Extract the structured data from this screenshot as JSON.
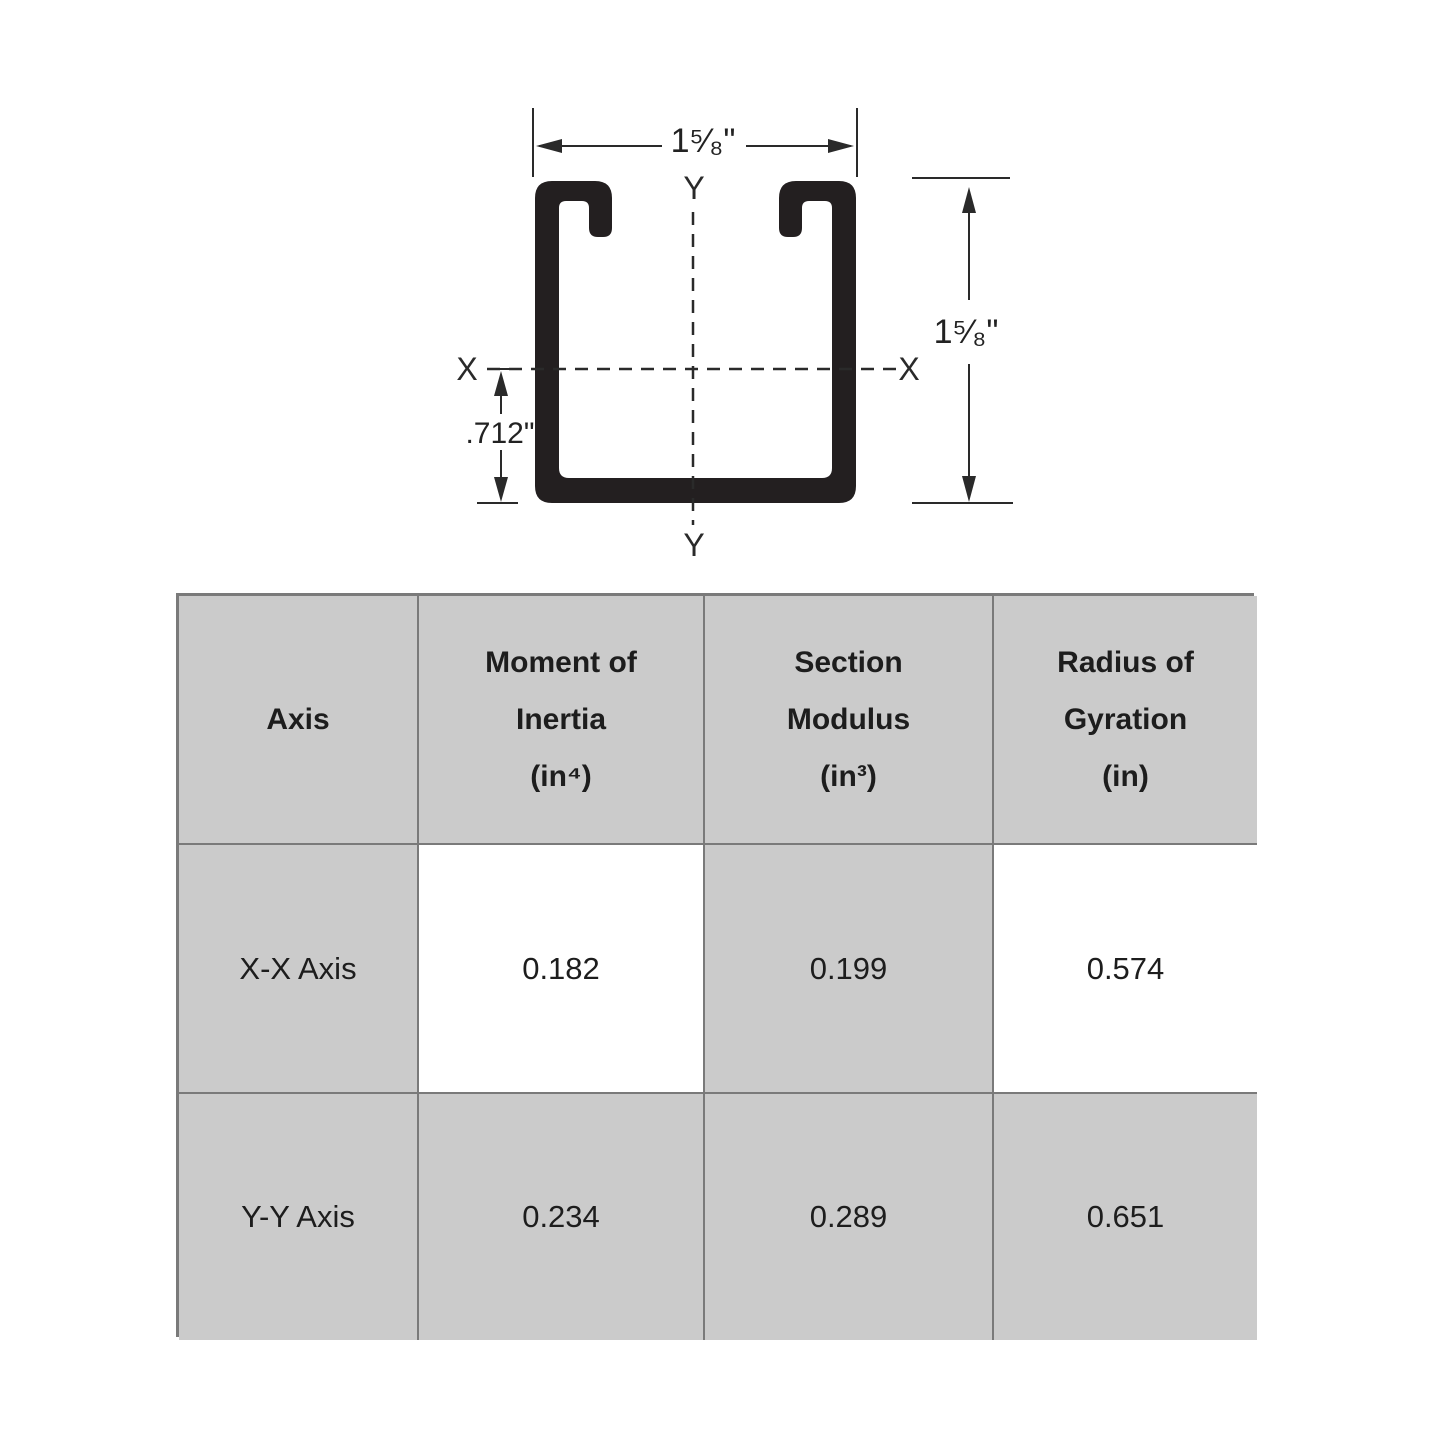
{
  "diagram": {
    "ink_color": "#231f20",
    "line_color": "#2a2a2a",
    "width_dim": "1⁵⁄₈\"",
    "height_dim": "1⁵⁄₈\"",
    "offset_dim": ".712\"",
    "axis_x_left": "X",
    "axis_x_right": "X",
    "axis_y_top": "Y",
    "axis_y_bottom": "Y"
  },
  "table": {
    "gray_color": "#cbcbcb",
    "white_color": "#ffffff",
    "border_color": "#7a7a7a",
    "headers": {
      "col1": "Axis",
      "col2_line1": "Moment of",
      "col2_line2": "Inertia",
      "col2_line3": "(in⁴)",
      "col3_line1": "Section",
      "col3_line2": "Modulus",
      "col3_line3": "(in³)",
      "col4_line1": "Radius of",
      "col4_line2": "Gyration",
      "col4_line3": "(in)"
    },
    "rows": [
      {
        "axis": "X-X Axis",
        "moment_of_inertia": "0.182",
        "section_modulus": "0.199",
        "radius_of_gyration": "0.574"
      },
      {
        "axis": "Y-Y Axis",
        "moment_of_inertia": "0.234",
        "section_modulus": "0.289",
        "radius_of_gyration": "0.651"
      }
    ]
  }
}
